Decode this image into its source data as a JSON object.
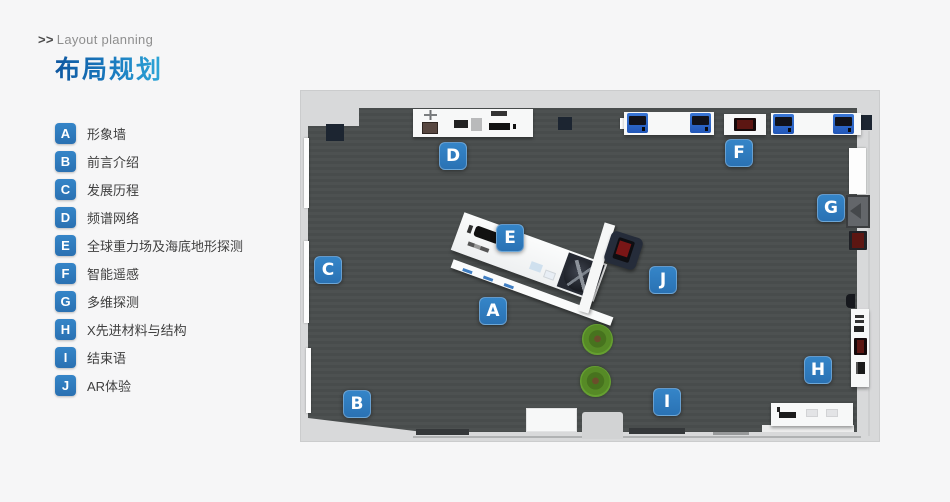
{
  "header": {
    "arrows": ">>",
    "subtitle": "Layout planning",
    "title": "布局规划",
    "title_gradient_start": "#0e57a0",
    "title_gradient_end": "#2fa8d8"
  },
  "legend": {
    "badge_color": "#2b79bd",
    "items": [
      {
        "letter": "A",
        "label": "形象墙"
      },
      {
        "letter": "B",
        "label": "前言介绍"
      },
      {
        "letter": "C",
        "label": "发展历程"
      },
      {
        "letter": "D",
        "label": "频谱网络"
      },
      {
        "letter": "E",
        "label": "全球重力场及海底地形探测"
      },
      {
        "letter": "F",
        "label": "智能遥感"
      },
      {
        "letter": "G",
        "label": "多维探测"
      },
      {
        "letter": "H",
        "label": "X先进材料与结构"
      },
      {
        "letter": "I",
        "label": "结束语"
      },
      {
        "letter": "J",
        "label": "AR体验"
      }
    ]
  },
  "plan": {
    "floor_color": "#4a4e4e",
    "outer_color": "#d8d9da",
    "marker_color": "#2f7cc0",
    "markers": [
      "A",
      "B",
      "C",
      "D",
      "E",
      "F",
      "G",
      "H",
      "I",
      "J"
    ]
  }
}
